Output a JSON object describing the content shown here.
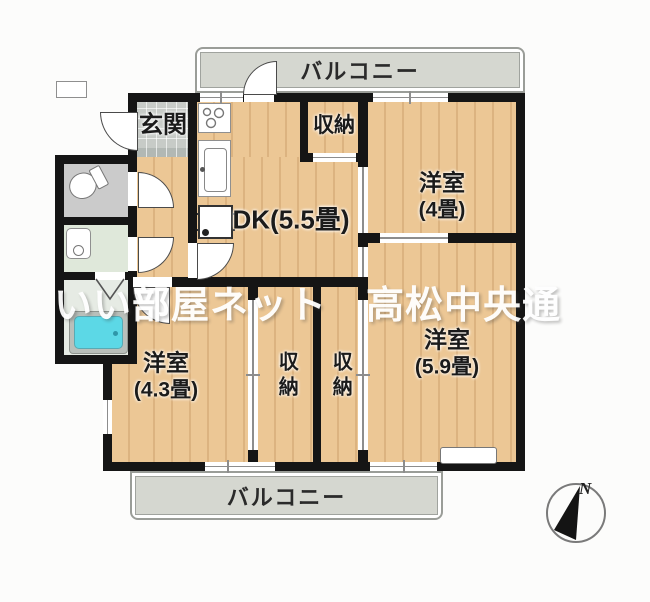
{
  "watermark": {
    "text": "いい部屋ネット　高松中央通",
    "color": "#ffffff"
  },
  "rooms": {
    "balcony_top": {
      "label": "バルコニー"
    },
    "balcony_bottom": {
      "label": "バルコニー"
    },
    "genkan": {
      "label": "玄関"
    },
    "dk": {
      "label": "DK(5.5畳)"
    },
    "closet_top": {
      "label": "収納"
    },
    "closet_left": {
      "label": "収納"
    },
    "closet_right": {
      "label": "収納"
    },
    "western_room_4": {
      "name": "洋室",
      "size": "(4畳)"
    },
    "western_room_43": {
      "name": "洋室",
      "size": "(4.3畳)"
    },
    "western_room_59": {
      "name": "洋室",
      "size": "(5.9畳)"
    }
  },
  "compass": {
    "label": "N"
  },
  "colors": {
    "wall": "#151515",
    "wood_floor": "#ecc795",
    "balcony_floor": "#d5d7d0",
    "entrance_tile": "#c7cbc7",
    "toilet_floor": "#cbcbcb",
    "washroom_floor": "#dfe8da",
    "bathroom_floor": "#e6ebe4",
    "bathtub": "#5cd8e6",
    "watermark": "#ffffff"
  }
}
